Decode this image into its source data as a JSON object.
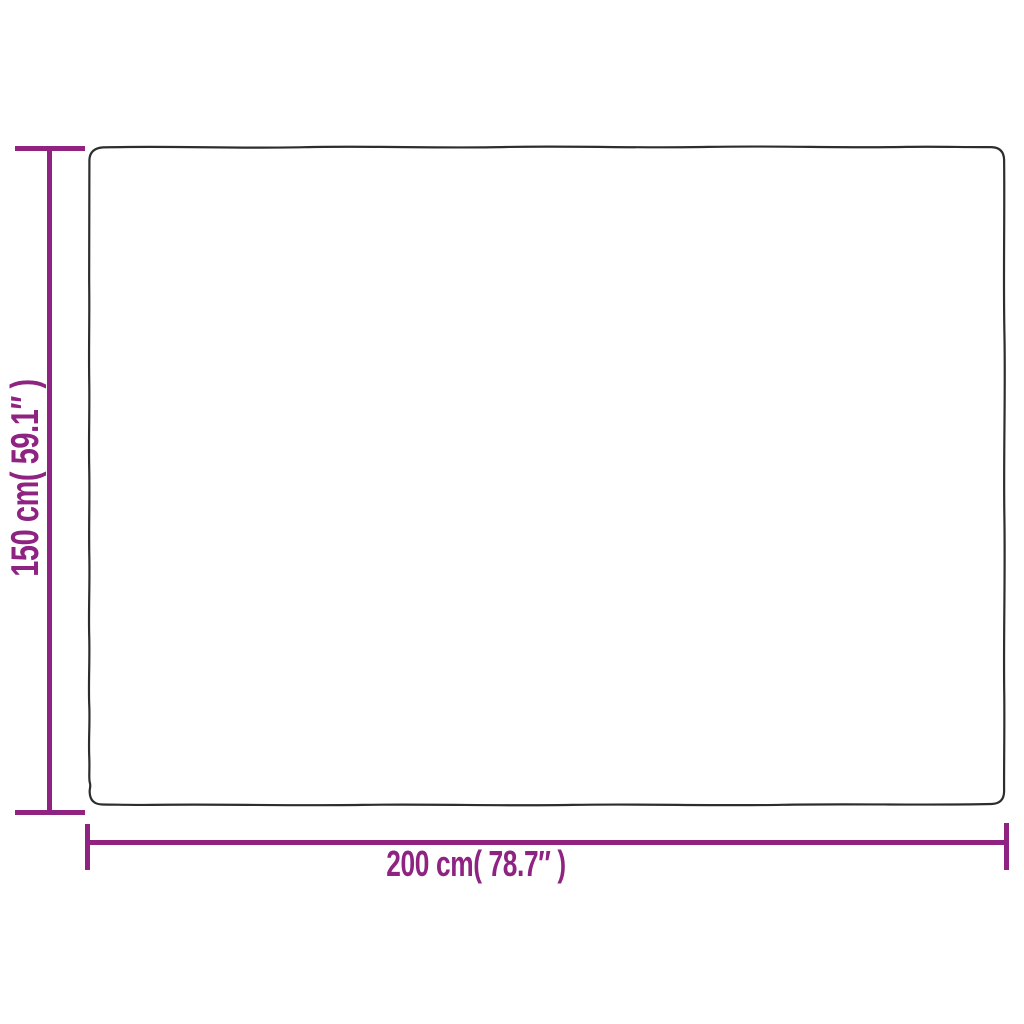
{
  "page": {
    "background": "#ffffff",
    "kind": "product-dimension-diagram"
  },
  "colors": {
    "dimension_lines": "#8e2382",
    "product_outline": "#2d2d2d"
  },
  "product": {
    "shape": "rectangle-outline"
  },
  "dimensions": {
    "height": {
      "label": "150 cm( 59.1″ )",
      "value_cm": "150",
      "value_inches": "59.1",
      "orientation": "vertical"
    },
    "width": {
      "label": "200 cm( 78.7″ )",
      "value_cm": "200",
      "value_inches": "78.7",
      "orientation": "horizontal"
    }
  }
}
